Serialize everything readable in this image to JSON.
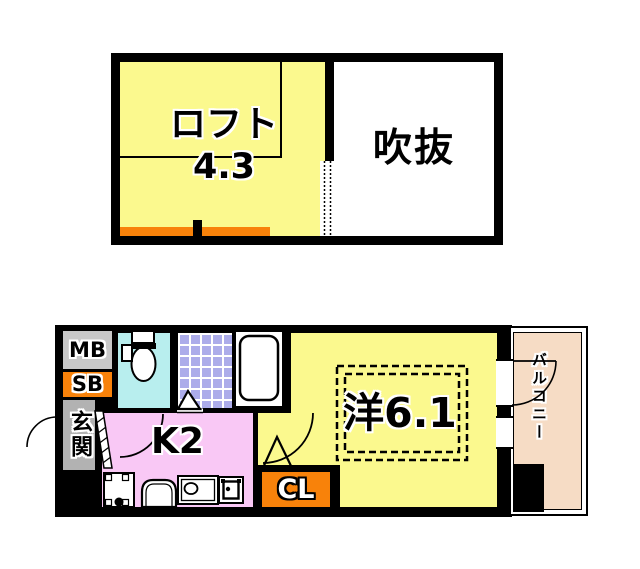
{
  "document": {
    "kind": "apartment-floor-plan"
  },
  "upper_floor": {
    "loft": {
      "label": "ロフト",
      "area": "4.3"
    },
    "void": {
      "label": "吹抜"
    }
  },
  "lower_floor": {
    "meter_box": {
      "label": "MB"
    },
    "storage_box": {
      "label": "SB"
    },
    "entrance": {
      "label": "玄関"
    },
    "kitchen": {
      "label": "K2"
    },
    "closet": {
      "label": "CL"
    },
    "western_room": {
      "label": "洋6.1"
    },
    "balcony": {
      "label": "バルコニー"
    }
  },
  "icons": [
    "toilet-icon",
    "bathtub-icon",
    "kitchen-sink-icon",
    "stove-icon",
    "washer-pan-icon",
    "entry-door-arc",
    "kitchen-door-arc",
    "room-door-arc",
    "balcony-door-arc",
    "bath-door-triangle",
    "room-door-triangle",
    "entry-step-hatch"
  ],
  "colors": {
    "wall_black": "#000000",
    "room_yellow": "#FBF98E",
    "kitchen_pink": "#F9C8F5",
    "accent_orange": "#F8820A",
    "toilet_cyan": "#B8EEEE",
    "bath_tile_lavender": "#ACACEA",
    "balcony_peach": "#F6DCC5",
    "meter_box_gray": "#C8C8C8",
    "entrance_gray": "#B2B2B2"
  }
}
